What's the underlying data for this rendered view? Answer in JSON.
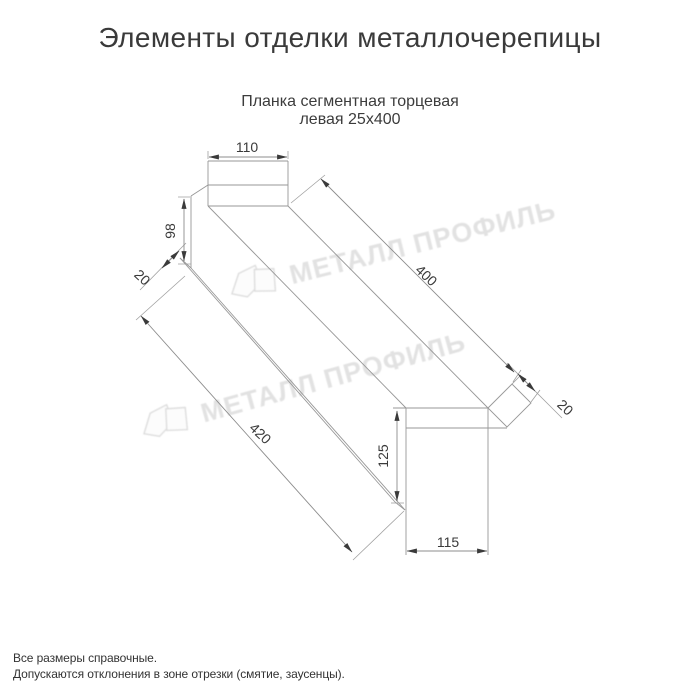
{
  "header": {
    "title": "Элементы отделки металлочерепицы",
    "subtitle_line1": "Планка сегментная торцевая",
    "subtitle_line2": "левая 25х400"
  },
  "footer": {
    "note1": "Все размеры справочные.",
    "note2": "Допускаются отклонения в зоне отрезки (смятие, заусенцы)."
  },
  "watermark": {
    "text": "МЕТАЛЛ ПРОФИЛЬ",
    "color": "#e2e2e2"
  },
  "drawing": {
    "type": "technical-dimension-drawing",
    "product": "Планка сегментная торцевая левая 25х400",
    "dimensions": {
      "top_flange_width": "110",
      "upper_web_height": "98",
      "upper_hem": "20",
      "flange_length": "400",
      "total_length": "420",
      "lower_hem": "20",
      "lower_web_height": "125",
      "bottom_flange_width": "115"
    },
    "colors": {
      "line": "#979797",
      "dimension_text": "#3a3a3a",
      "title_text": "#3a3a3a"
    }
  }
}
